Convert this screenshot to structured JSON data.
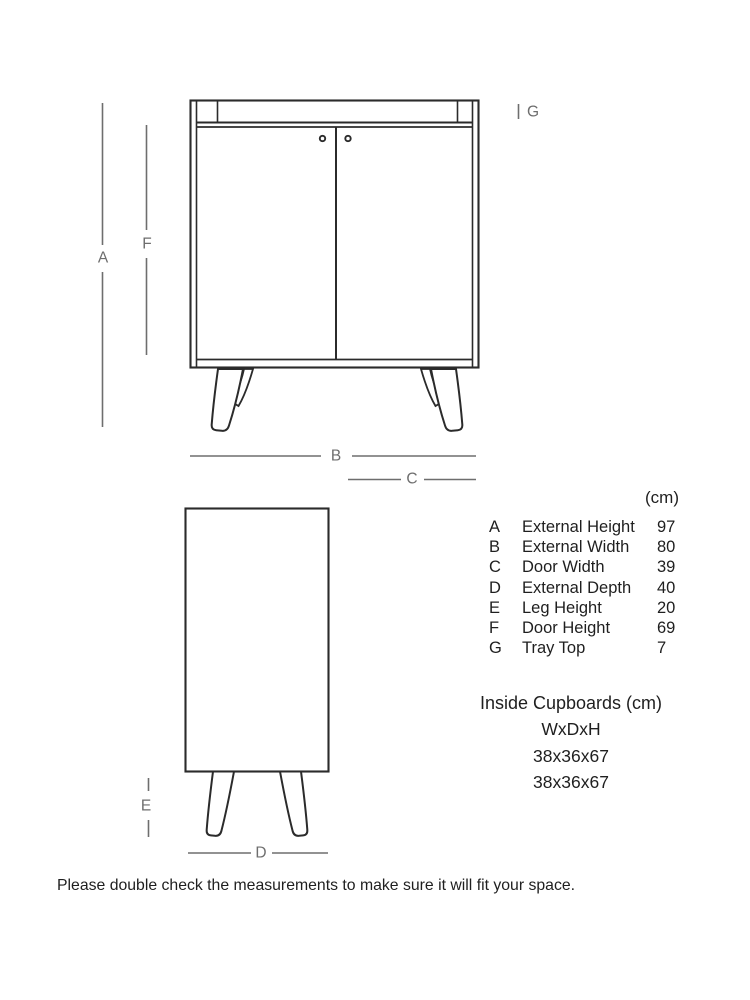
{
  "colors": {
    "art_line": "#2b2b2b",
    "dim_line": "#6e6e6e",
    "dim_label": "#6e6e6e",
    "text_color": "#1f1f1f",
    "page_bg": "#ffffff"
  },
  "diagram": {
    "dim_labels": {
      "a": "A",
      "b": "B",
      "c": "C",
      "d": "D",
      "e": "E",
      "f": "F",
      "g": "G"
    }
  },
  "dimensions_table": {
    "unit_header": "(cm)",
    "rows": [
      {
        "key": "A",
        "name": "External Height",
        "value": "97"
      },
      {
        "key": "B",
        "name": "External Width",
        "value": "80"
      },
      {
        "key": "C",
        "name": "Door Width",
        "value": "39"
      },
      {
        "key": "D",
        "name": "External Depth",
        "value": "40"
      },
      {
        "key": "E",
        "name": "Leg Height",
        "value": "20"
      },
      {
        "key": "F",
        "name": "Door Height",
        "value": "69"
      },
      {
        "key": "G",
        "name": "Tray Top",
        "value": "7"
      }
    ]
  },
  "inside_cupboards": {
    "title": "Inside Cupboards (cm)",
    "format_label": "WxDxH",
    "sizes": [
      "38x36x67",
      "38x36x67"
    ]
  },
  "footnote": "Please double check the measurements to make sure it will fit your space."
}
